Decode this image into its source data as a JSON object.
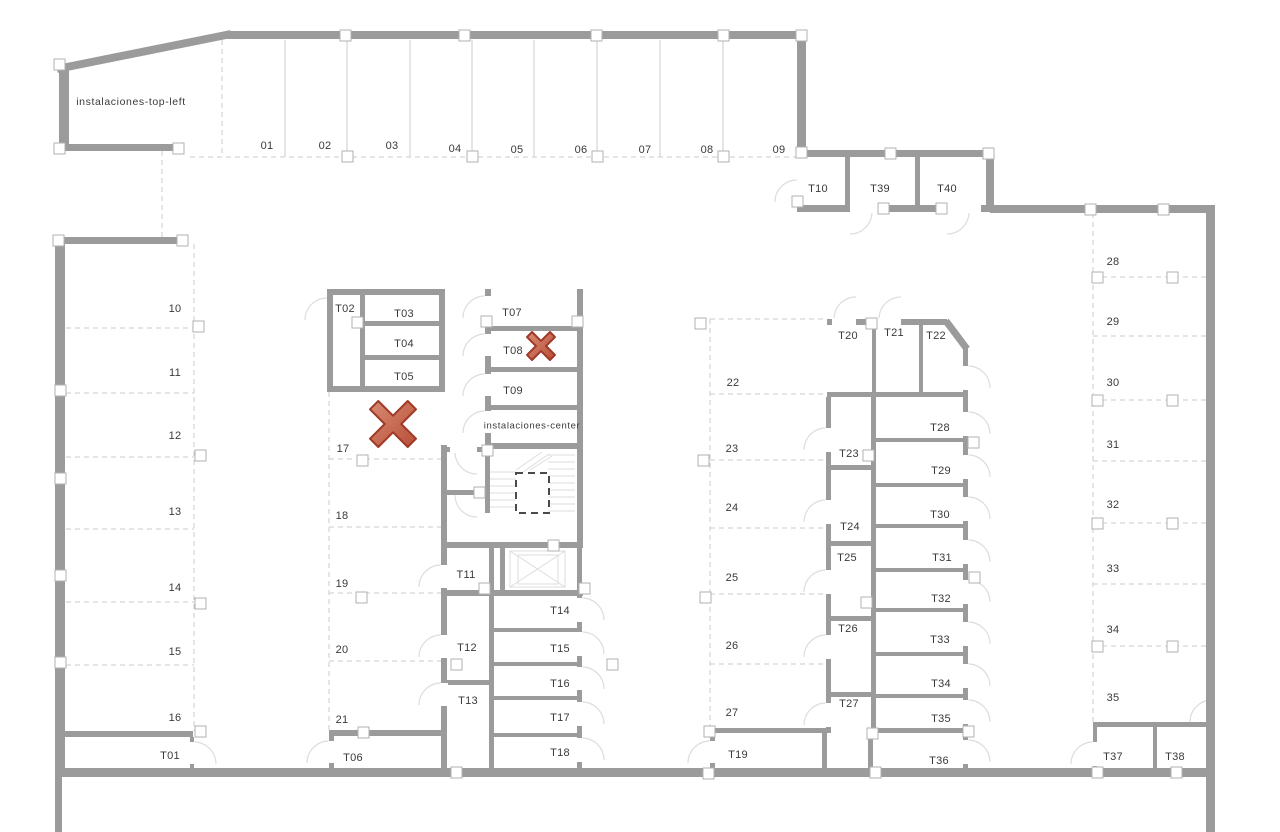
{
  "floorplan": {
    "type": "parking-garage-floor-plan",
    "area_labels": [
      {
        "id": "instalaciones-top-left",
        "text": "INSTALACIONES",
        "x": 131,
        "y": 102,
        "size": 10.5
      },
      {
        "id": "instalaciones-center",
        "text": "INSTALACIONES",
        "x": 532,
        "y": 426,
        "size": 9.5
      }
    ],
    "parking_stalls": [
      {
        "id": "01",
        "x": 267,
        "y": 146
      },
      {
        "id": "02",
        "x": 325,
        "y": 146
      },
      {
        "id": "03",
        "x": 392,
        "y": 146
      },
      {
        "id": "04",
        "x": 455,
        "y": 149
      },
      {
        "id": "05",
        "x": 517,
        "y": 150
      },
      {
        "id": "06",
        "x": 581,
        "y": 150
      },
      {
        "id": "07",
        "x": 645,
        "y": 150
      },
      {
        "id": "08",
        "x": 707,
        "y": 150
      },
      {
        "id": "09",
        "x": 779,
        "y": 150
      },
      {
        "id": "10",
        "x": 175,
        "y": 309
      },
      {
        "id": "11",
        "x": 175,
        "y": 373
      },
      {
        "id": "12",
        "x": 175,
        "y": 436
      },
      {
        "id": "13",
        "x": 175,
        "y": 512
      },
      {
        "id": "14",
        "x": 175,
        "y": 588
      },
      {
        "id": "15",
        "x": 175,
        "y": 652
      },
      {
        "id": "16",
        "x": 175,
        "y": 718
      },
      {
        "id": "17",
        "x": 343,
        "y": 449
      },
      {
        "id": "18",
        "x": 342,
        "y": 516
      },
      {
        "id": "19",
        "x": 342,
        "y": 584
      },
      {
        "id": "20",
        "x": 342,
        "y": 650
      },
      {
        "id": "21",
        "x": 342,
        "y": 720
      },
      {
        "id": "22",
        "x": 733,
        "y": 383
      },
      {
        "id": "23",
        "x": 732,
        "y": 449
      },
      {
        "id": "24",
        "x": 732,
        "y": 508
      },
      {
        "id": "25",
        "x": 732,
        "y": 578
      },
      {
        "id": "26",
        "x": 732,
        "y": 646
      },
      {
        "id": "27",
        "x": 732,
        "y": 713
      },
      {
        "id": "28",
        "x": 1113,
        "y": 262
      },
      {
        "id": "29",
        "x": 1113,
        "y": 322
      },
      {
        "id": "30",
        "x": 1113,
        "y": 383
      },
      {
        "id": "31",
        "x": 1113,
        "y": 445
      },
      {
        "id": "32",
        "x": 1113,
        "y": 505
      },
      {
        "id": "33",
        "x": 1113,
        "y": 569
      },
      {
        "id": "34",
        "x": 1113,
        "y": 630
      },
      {
        "id": "35",
        "x": 1113,
        "y": 698
      }
    ],
    "storage_rooms": [
      {
        "id": "T01",
        "x": 170,
        "y": 756
      },
      {
        "id": "T02",
        "x": 345,
        "y": 309
      },
      {
        "id": "T03",
        "x": 404,
        "y": 314
      },
      {
        "id": "T04",
        "x": 404,
        "y": 344
      },
      {
        "id": "T05",
        "x": 404,
        "y": 377
      },
      {
        "id": "T06",
        "x": 353,
        "y": 758
      },
      {
        "id": "T07",
        "x": 512,
        "y": 313
      },
      {
        "id": "T08",
        "x": 513,
        "y": 351
      },
      {
        "id": "T09",
        "x": 513,
        "y": 391
      },
      {
        "id": "T10",
        "x": 818,
        "y": 189
      },
      {
        "id": "T11",
        "x": 466,
        "y": 575
      },
      {
        "id": "T12",
        "x": 467,
        "y": 648
      },
      {
        "id": "T13",
        "x": 468,
        "y": 701
      },
      {
        "id": "T14",
        "x": 560,
        "y": 611
      },
      {
        "id": "T15",
        "x": 560,
        "y": 649
      },
      {
        "id": "T16",
        "x": 560,
        "y": 684
      },
      {
        "id": "T17",
        "x": 560,
        "y": 718
      },
      {
        "id": "T18",
        "x": 560,
        "y": 753
      },
      {
        "id": "T19",
        "x": 738,
        "y": 755
      },
      {
        "id": "T20",
        "x": 848,
        "y": 336
      },
      {
        "id": "T21",
        "x": 894,
        "y": 333
      },
      {
        "id": "T22",
        "x": 936,
        "y": 336
      },
      {
        "id": "T23",
        "x": 849,
        "y": 454
      },
      {
        "id": "T24",
        "x": 850,
        "y": 527
      },
      {
        "id": "T25",
        "x": 847,
        "y": 558
      },
      {
        "id": "T26",
        "x": 848,
        "y": 629
      },
      {
        "id": "T27",
        "x": 849,
        "y": 704
      },
      {
        "id": "T28",
        "x": 940,
        "y": 428
      },
      {
        "id": "T29",
        "x": 941,
        "y": 471
      },
      {
        "id": "T30",
        "x": 940,
        "y": 515
      },
      {
        "id": "T31",
        "x": 942,
        "y": 558
      },
      {
        "id": "T32",
        "x": 941,
        "y": 599
      },
      {
        "id": "T33",
        "x": 940,
        "y": 640
      },
      {
        "id": "T34",
        "x": 941,
        "y": 684
      },
      {
        "id": "T35",
        "x": 941,
        "y": 719
      },
      {
        "id": "T36",
        "x": 939,
        "y": 761
      },
      {
        "id": "T37",
        "x": 1113,
        "y": 757
      },
      {
        "id": "T38",
        "x": 1175,
        "y": 757
      },
      {
        "id": "T39",
        "x": 880,
        "y": 189
      },
      {
        "id": "T40",
        "x": 947,
        "y": 189
      }
    ],
    "x_marks": [
      {
        "x": 393,
        "y": 424,
        "size": 46
      },
      {
        "x": 541,
        "y": 346,
        "size": 28
      }
    ],
    "colors": {
      "wall": "#9b9b9b",
      "divider": "#cbcbcb",
      "door_arc": "#dedede",
      "label": "#3a3a3a",
      "x_fill_light": "#d98b74",
      "x_fill_dark": "#b84e37",
      "x_stroke": "#9e3a27"
    }
  }
}
